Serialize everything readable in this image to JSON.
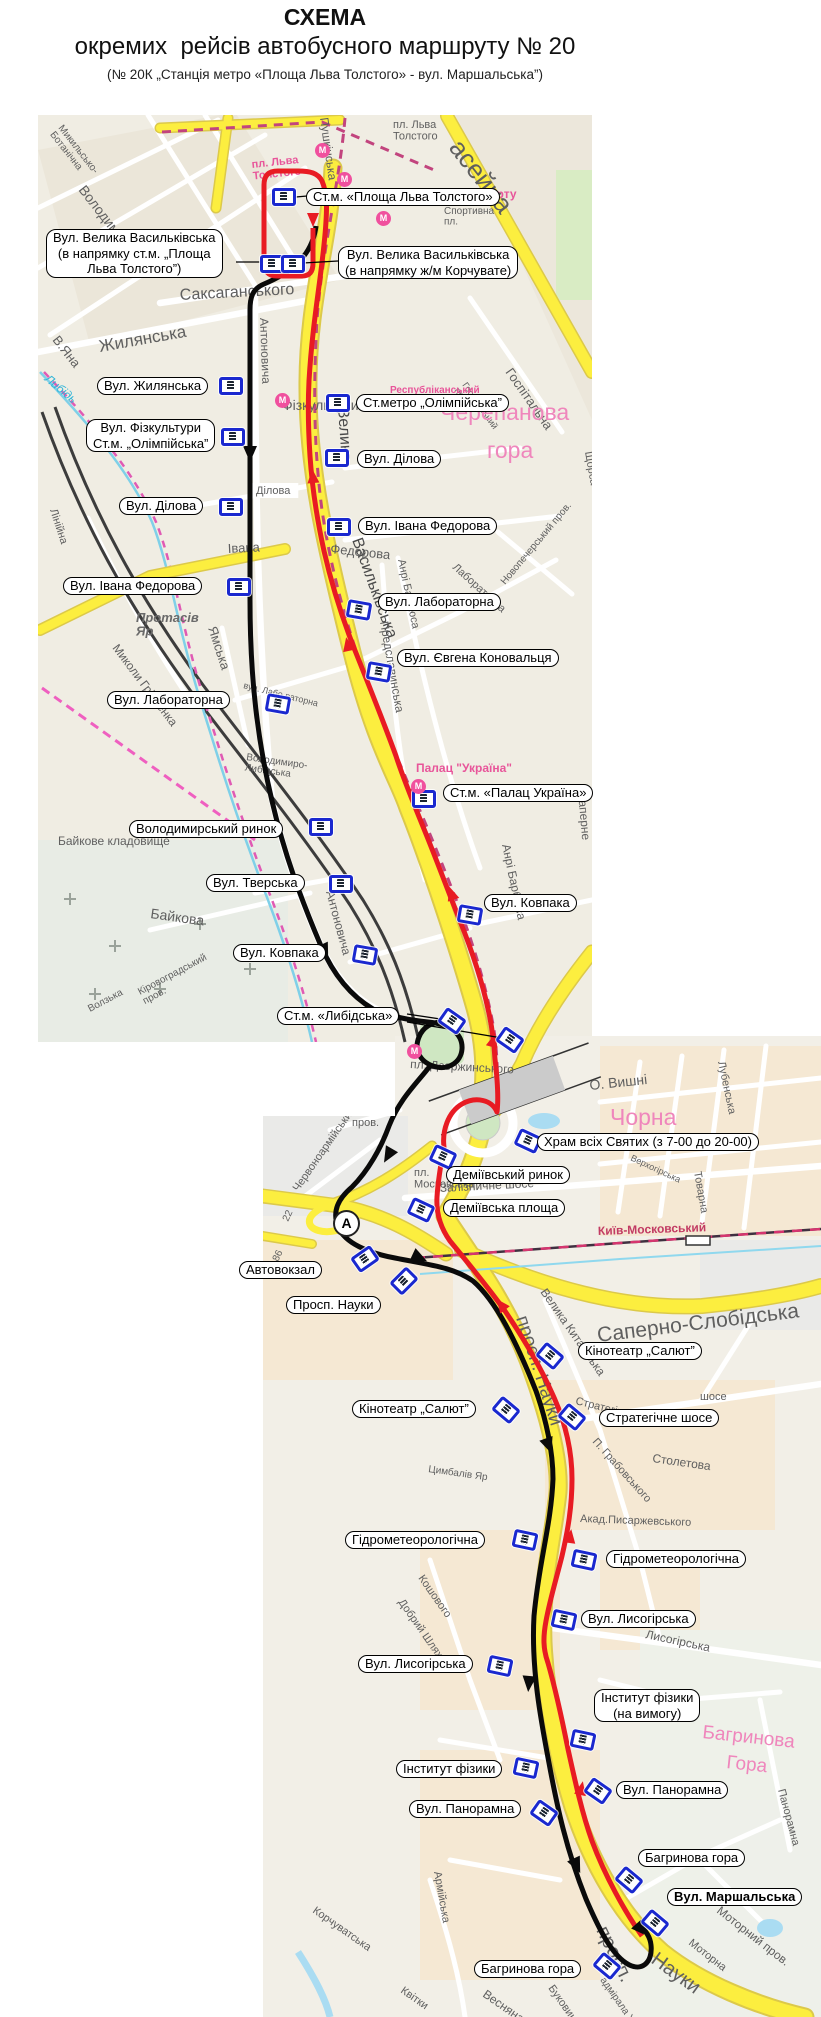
{
  "title": {
    "line1": "СХЕМА",
    "line2": "окремих  рейсів автобусного маршруту № 20",
    "line3": "(№ 20К „Станція метро «Площа Льва Толстого» - вул. Маршальська”)"
  },
  "colors": {
    "road-yellow": "#fcee3f",
    "road-casing": "#dcc94a",
    "route-red": "#e81b23",
    "route-black": "#0a0a0a",
    "metro-dash": "#c2447e",
    "map1-bg": "#f0ede3",
    "map2-bg": "#f2efe7",
    "label-border": "#000000",
    "busstop-blue": "#1a28cf",
    "metro-pink": "#f0509e"
  },
  "stop_labels": [
    {
      "text": "Ст.м. «Площа Льва Толстого»",
      "x": 306,
      "y": 188
    },
    {
      "text": "Вул. Велика Васильківська\n(в напрямку ст.м. „Площа\nЛьва Толстого”)",
      "x": 46,
      "y": 229
    },
    {
      "text": "Вул. Велика Васильківська\n(в напрямку ж/м Корчувате)",
      "x": 338,
      "y": 246
    },
    {
      "text": "Вул. Жилянська",
      "x": 97,
      "y": 377
    },
    {
      "text": "Вул. Фізкультури\nСт.м. „Олімпійська”",
      "x": 86,
      "y": 419
    },
    {
      "text": "Ст.метро „Олімпійська”",
      "x": 356,
      "y": 394
    },
    {
      "text": "Вул. Ділова",
      "x": 357,
      "y": 450
    },
    {
      "text": "Вул. Ділова",
      "x": 119,
      "y": 497
    },
    {
      "text": "Вул. Івана Федорова",
      "x": 358,
      "y": 517
    },
    {
      "text": "Вул. Івана Федорова",
      "x": 63,
      "y": 577
    },
    {
      "text": "Вул. Лабораторна",
      "x": 378,
      "y": 593
    },
    {
      "text": "Вул. Євгена Коновальця",
      "x": 397,
      "y": 649
    },
    {
      "text": "Вул. Лабораторна",
      "x": 107,
      "y": 691
    },
    {
      "text": "Ст.м. «Палац Україна»",
      "x": 443,
      "y": 784
    },
    {
      "text": "Володимирський ринок",
      "x": 129,
      "y": 820
    },
    {
      "text": "Вул. Тверська",
      "x": 206,
      "y": 874
    },
    {
      "text": "Вул. Ковпака",
      "x": 484,
      "y": 894
    },
    {
      "text": "Вул. Ковпака",
      "x": 233,
      "y": 944
    },
    {
      "text": "Ст.м. «Либідська»",
      "x": 277,
      "y": 1007
    },
    {
      "text": "Храм всіх Святих (з 7-00 до 20-00)",
      "x": 537,
      "y": 1133
    },
    {
      "text": "Деміївський ринок",
      "x": 446,
      "y": 1166
    },
    {
      "text": "Деміївська площа",
      "x": 443,
      "y": 1199
    },
    {
      "text": "Автовокзал",
      "x": 239,
      "y": 1261
    },
    {
      "text": "Просп. Науки",
      "x": 286,
      "y": 1296
    },
    {
      "text": "Кінотеатр „Салют”",
      "x": 578,
      "y": 1342
    },
    {
      "text": "Кінотеатр „Салют”",
      "x": 352,
      "y": 1400
    },
    {
      "text": "Стратегічне шосе",
      "x": 599,
      "y": 1409
    },
    {
      "text": "Гідрометеорологічна",
      "x": 345,
      "y": 1531
    },
    {
      "text": "Гідрометеорологічна",
      "x": 606,
      "y": 1550
    },
    {
      "text": "Вул. Лисогірська",
      "x": 581,
      "y": 1610
    },
    {
      "text": "Вул. Лисогірська",
      "x": 358,
      "y": 1655
    },
    {
      "text": "Інститут фізики\n(на вимогу)",
      "x": 594,
      "y": 1689
    },
    {
      "text": "Інститут фізики",
      "x": 396,
      "y": 1760
    },
    {
      "text": "Вул. Панорамна",
      "x": 616,
      "y": 1781
    },
    {
      "text": "Вул. Панорамна",
      "x": 409,
      "y": 1800
    },
    {
      "text": "Багринова гора",
      "x": 638,
      "y": 1849
    },
    {
      "text": "Вул. Маршальська",
      "x": 667,
      "y": 1888,
      "bold": true
    },
    {
      "text": "Багринова гора",
      "x": 474,
      "y": 1960
    }
  ],
  "bus_stops": [
    [
      284,
      197,
      0
    ],
    [
      272,
      264,
      0
    ],
    [
      293,
      264,
      0
    ],
    [
      231,
      386,
      0
    ],
    [
      233,
      437,
      0
    ],
    [
      338,
      403,
      0
    ],
    [
      337,
      458,
      0
    ],
    [
      231,
      507,
      0
    ],
    [
      339,
      527,
      0
    ],
    [
      239,
      587,
      0
    ],
    [
      359,
      610,
      10
    ],
    [
      379,
      672,
      10
    ],
    [
      278,
      704,
      10
    ],
    [
      424,
      799,
      0
    ],
    [
      321,
      827,
      0
    ],
    [
      341,
      884,
      0
    ],
    [
      470,
      915,
      10
    ],
    [
      365,
      955,
      10
    ],
    [
      452,
      1021,
      35
    ],
    [
      510,
      1040,
      35
    ],
    [
      528,
      1141,
      25
    ],
    [
      443,
      1157,
      25
    ],
    [
      421,
      1210,
      25
    ],
    [
      365,
      1259,
      -35
    ],
    [
      404,
      1281,
      -45
    ],
    [
      550,
      1356,
      40
    ],
    [
      506,
      1410,
      40
    ],
    [
      572,
      1417,
      40
    ],
    [
      525,
      1540,
      12
    ],
    [
      584,
      1560,
      12
    ],
    [
      564,
      1620,
      12
    ],
    [
      500,
      1666,
      12
    ],
    [
      583,
      1740,
      12
    ],
    [
      526,
      1768,
      12
    ],
    [
      598,
      1791,
      35
    ],
    [
      544,
      1813,
      35
    ],
    [
      629,
      1880,
      40
    ],
    [
      655,
      1923,
      40
    ],
    [
      607,
      1966,
      40
    ]
  ],
  "metro_icons": [
    [
      322,
      150
    ],
    [
      344,
      179
    ],
    [
      383,
      218
    ],
    [
      282,
      400
    ],
    [
      418,
      786
    ],
    [
      414,
      1051
    ]
  ],
  "bus_station_icon": {
    "label": "А",
    "x": 345,
    "y": 1222
  },
  "connectors": [
    [
      236,
      262,
      268,
      262
    ],
    [
      338,
      261,
      303,
      263
    ],
    [
      407,
      1014,
      447,
      1020
    ],
    [
      407,
      1022,
      502,
      1038
    ],
    [
      540,
      1146,
      533,
      1141
    ],
    [
      307,
      196,
      296,
      197
    ]
  ],
  "street_names": [
    {
      "t": "Жилянська",
      "x": 100,
      "y": 352,
      "r": -10,
      "s": 17
    },
    {
      "t": "В.Яна",
      "x": 52,
      "y": 340,
      "r": 52,
      "s": 13
    },
    {
      "t": "Микильсько-\nБотанічна",
      "x": 58,
      "y": 128,
      "r": 52,
      "s": 10
    },
    {
      "t": "Володимирська",
      "x": 78,
      "y": 190,
      "r": 52,
      "s": 14
    },
    {
      "t": "Антоновича",
      "x": 260,
      "y": 318,
      "r": 88,
      "s": 12
    },
    {
      "t": "Антоновича",
      "x": 326,
      "y": 892,
      "r": 75,
      "s": 12
    },
    {
      "t": "Саксаганського",
      "x": 180,
      "y": 300,
      "r": -3,
      "s": 16
    },
    {
      "t": "Велика",
      "x": 338,
      "y": 408,
      "r": 86,
      "s": 16,
      "c": "onroad"
    },
    {
      "t": "Васильківська",
      "x": 352,
      "y": 540,
      "r": 70,
      "s": 16,
      "c": "onroad"
    },
    {
      "t": "пл. Льва\nТолстого",
      "x": 252,
      "y": 168,
      "r": -6,
      "s": 11,
      "c": "pink2"
    },
    {
      "t": "пл. Льва\nТолстого",
      "x": 393,
      "y": 128,
      "r": 0,
      "s": 11
    },
    {
      "t": "Палац Спорту",
      "x": 433,
      "y": 198,
      "r": 0,
      "s": 12,
      "c": "pink2"
    },
    {
      "t": "Спортивна\nпл.",
      "x": 444,
      "y": 214,
      "r": 0,
      "s": 10
    },
    {
      "t": "асейна",
      "x": 448,
      "y": 148,
      "r": 52,
      "s": 26
    },
    {
      "t": "Госпітальна",
      "x": 505,
      "y": 372,
      "r": 55,
      "s": 13
    },
    {
      "t": "Госпітальний\nпров.",
      "x": 462,
      "y": 385,
      "r": 55,
      "s": 9
    },
    {
      "t": "Пушкінська",
      "x": 320,
      "y": 118,
      "r": 82,
      "s": 12
    },
    {
      "t": "Фізкультури",
      "x": 282,
      "y": 410,
      "r": 0,
      "s": 14
    },
    {
      "t": "Ділова",
      "x": 256,
      "y": 494,
      "r": 0,
      "s": 11,
      "c": "whitebox"
    },
    {
      "t": "Черепанова",
      "x": 440,
      "y": 420,
      "r": 0,
      "s": 23,
      "c": "pink"
    },
    {
      "t": "гора",
      "x": 487,
      "y": 458,
      "r": 0,
      "s": 23,
      "c": "pink"
    },
    {
      "t": "Республіканський",
      "x": 390,
      "y": 393,
      "r": 0,
      "s": 10,
      "c": "pink2"
    },
    {
      "t": "Івана",
      "x": 228,
      "y": 553,
      "r": -3,
      "s": 13
    },
    {
      "t": "Федорова",
      "x": 330,
      "y": 553,
      "r": 6,
      "s": 13
    },
    {
      "t": "Протасів\nЯр",
      "x": 136,
      "y": 622,
      "r": 0,
      "s": 13,
      "c": "boldit"
    },
    {
      "t": "Ямська",
      "x": 208,
      "y": 628,
      "r": 72,
      "s": 13
    },
    {
      "t": "Миколи Грінченка",
      "x": 112,
      "y": 648,
      "r": 53,
      "s": 12
    },
    {
      "t": "вул. Лабо раторна",
      "x": 243,
      "y": 688,
      "r": 14,
      "s": 9
    },
    {
      "t": "Володимиро-\nЛибідська",
      "x": 246,
      "y": 760,
      "r": 8,
      "s": 10
    },
    {
      "t": "Байкова",
      "x": 150,
      "y": 918,
      "r": 8,
      "s": 14
    },
    {
      "t": "Байкове  кладовище",
      "x": 58,
      "y": 845,
      "r": 0,
      "s": 12
    },
    {
      "t": "Кіровоградський\nпров.",
      "x": 140,
      "y": 995,
      "r": -28,
      "s": 10
    },
    {
      "t": "Волзька",
      "x": 90,
      "y": 1012,
      "r": -28,
      "s": 10
    },
    {
      "t": "Лінійна",
      "x": 50,
      "y": 510,
      "r": 72,
      "s": 11
    },
    {
      "t": "Либідь",
      "x": 44,
      "y": 380,
      "r": 40,
      "s": 12,
      "c": "water"
    },
    {
      "t": "Саперне",
      "x": 578,
      "y": 792,
      "r": 85,
      "s": 12
    },
    {
      "t": "Анрі Барбюса",
      "x": 398,
      "y": 560,
      "r": 78,
      "s": 11
    },
    {
      "t": "Анрі Барбюса",
      "x": 502,
      "y": 845,
      "r": 78,
      "s": 12
    },
    {
      "t": "Предславинська",
      "x": 380,
      "y": 622,
      "r": 80,
      "s": 12
    },
    {
      "t": "Новопечерський пров.",
      "x": 505,
      "y": 585,
      "r": -50,
      "s": 10
    },
    {
      "t": "Палац \"Україна\"",
      "x": 416,
      "y": 772,
      "r": 0,
      "s": 12,
      "c": "pink2"
    },
    {
      "t": "Лабораторна",
      "x": 452,
      "y": 568,
      "r": 42,
      "s": 11
    },
    {
      "t": "Щорса",
      "x": 585,
      "y": 452,
      "r": 80,
      "s": 11
    },
    {
      "t": "Чорна",
      "x": 610,
      "y": 1125,
      "r": 0,
      "s": 23,
      "c": "pink"
    },
    {
      "t": "О. Вишні",
      "x": 590,
      "y": 1090,
      "r": -6,
      "s": 14
    },
    {
      "t": "Лубенська",
      "x": 718,
      "y": 1062,
      "r": 78,
      "s": 11
    },
    {
      "t": "Товарна",
      "x": 694,
      "y": 1172,
      "r": 80,
      "s": 11
    },
    {
      "t": "Верхогірська",
      "x": 630,
      "y": 1160,
      "r": 25,
      "s": 9
    },
    {
      "t": "Київ-Московський",
      "x": 598,
      "y": 1235,
      "r": -2,
      "s": 12,
      "c": "rail"
    },
    {
      "t": "Залізничне шосе",
      "x": 440,
      "y": 1192,
      "r": -3,
      "s": 12
    },
    {
      "t": "пл.\nМосковська",
      "x": 414,
      "y": 1176,
      "r": 0,
      "s": 11
    },
    {
      "t": "пров.",
      "x": 352,
      "y": 1126,
      "r": 0,
      "s": 11
    },
    {
      "t": "Червоноармійський",
      "x": 298,
      "y": 1192,
      "r": -55,
      "s": 11
    },
    {
      "t": "пл. Дзержинського",
      "x": 410,
      "y": 1068,
      "r": 3,
      "s": 12
    },
    {
      "t": "Саперно-Слобідська",
      "x": 598,
      "y": 1342,
      "r": -7,
      "s": 21
    },
    {
      "t": "просп. Науки",
      "x": 516,
      "y": 1318,
      "r": 72,
      "s": 19
    },
    {
      "t": "просп.",
      "x": 596,
      "y": 1930,
      "r": 64,
      "s": 20
    },
    {
      "t": "Науки",
      "x": 650,
      "y": 1962,
      "r": 36,
      "s": 20
    },
    {
      "t": "Велика Китаївська",
      "x": 540,
      "y": 1292,
      "r": 55,
      "s": 12
    },
    {
      "t": "Стратегічне",
      "x": 575,
      "y": 1404,
      "r": 14,
      "s": 11
    },
    {
      "t": "шосе",
      "x": 700,
      "y": 1400,
      "r": 0,
      "s": 11
    },
    {
      "t": "П. Грабовського",
      "x": 592,
      "y": 1442,
      "r": 48,
      "s": 11
    },
    {
      "t": "Столетова",
      "x": 652,
      "y": 1462,
      "r": 8,
      "s": 12
    },
    {
      "t": "Акад.Писаржевського",
      "x": 580,
      "y": 1522,
      "r": 2,
      "s": 11
    },
    {
      "t": "Цимбалів Яр",
      "x": 428,
      "y": 1472,
      "r": 8,
      "s": 10
    },
    {
      "t": "Лисогірська",
      "x": 645,
      "y": 1638,
      "r": 12,
      "s": 12
    },
    {
      "t": "Кошового",
      "x": 418,
      "y": 1578,
      "r": 55,
      "s": 11
    },
    {
      "t": "Добрий Шлях",
      "x": 398,
      "y": 1602,
      "r": 55,
      "s": 11
    },
    {
      "t": "Багринова",
      "x": 702,
      "y": 1738,
      "r": 6,
      "s": 19,
      "c": "pink"
    },
    {
      "t": "Гора",
      "x": 726,
      "y": 1768,
      "r": 6,
      "s": 19,
      "c": "pink"
    },
    {
      "t": "Армійська",
      "x": 434,
      "y": 1872,
      "r": 80,
      "s": 11
    },
    {
      "t": "Корчуватська",
      "x": 312,
      "y": 1912,
      "r": 35,
      "s": 11
    },
    {
      "t": "Весняна",
      "x": 482,
      "y": 1996,
      "r": 35,
      "s": 12
    },
    {
      "t": "Буковинська",
      "x": 548,
      "y": 1988,
      "r": 55,
      "s": 11
    },
    {
      "t": "Квітки",
      "x": 400,
      "y": 1992,
      "r": 35,
      "s": 11
    },
    {
      "t": "Моторна",
      "x": 688,
      "y": 1944,
      "r": 38,
      "s": 11
    },
    {
      "t": "Моторний пров.",
      "x": 716,
      "y": 1912,
      "r": 38,
      "s": 12
    },
    {
      "t": "Панорамна",
      "x": 778,
      "y": 1790,
      "r": 75,
      "s": 11
    },
    {
      "t": "адмірала Ушакова",
      "x": 600,
      "y": 1980,
      "r": 55,
      "s": 10
    },
    {
      "t": "22",
      "x": 288,
      "y": 1222,
      "r": -65,
      "s": 10
    },
    {
      "t": "86",
      "x": 278,
      "y": 1262,
      "r": -65,
      "s": 10
    }
  ]
}
